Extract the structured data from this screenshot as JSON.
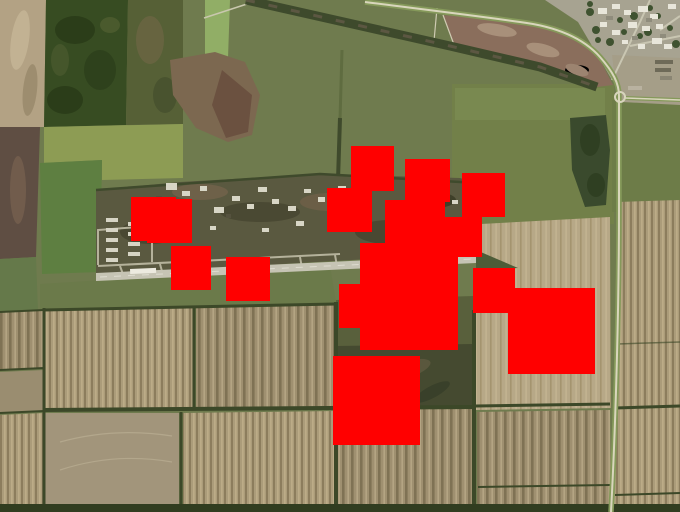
{
  "map": {
    "view": "satellite",
    "scene": {
      "description": "Aerial satellite view of a military airfield with runway, taxiways and aircraft stands, surrounded by plowed crop parcels, a forest block, tree-lined roads and a village in the upper right.",
      "features": [
        "airfield-base",
        "runway",
        "parking-apron",
        "forest",
        "farm-parcels",
        "village",
        "roads",
        "tree-lines"
      ]
    }
  },
  "overlays": {
    "color": "#ff0000",
    "shape": "square",
    "count": 15,
    "boxes": [
      {
        "x": 131,
        "y": 197,
        "w": 45,
        "h": 44
      },
      {
        "x": 147,
        "y": 199,
        "w": 45,
        "h": 44
      },
      {
        "x": 171,
        "y": 246,
        "w": 40,
        "h": 44
      },
      {
        "x": 226,
        "y": 257,
        "w": 44,
        "h": 44
      },
      {
        "x": 351,
        "y": 146,
        "w": 43,
        "h": 45
      },
      {
        "x": 405,
        "y": 159,
        "w": 45,
        "h": 43
      },
      {
        "x": 462,
        "y": 173,
        "w": 43,
        "h": 44
      },
      {
        "x": 327,
        "y": 188,
        "w": 45,
        "h": 44
      },
      {
        "x": 385,
        "y": 200,
        "w": 60,
        "h": 47
      },
      {
        "x": 441,
        "y": 217,
        "w": 41,
        "h": 40
      },
      {
        "x": 360,
        "y": 243,
        "w": 98,
        "h": 107
      },
      {
        "x": 339,
        "y": 284,
        "w": 46,
        "h": 44
      },
      {
        "x": 473,
        "y": 268,
        "w": 42,
        "h": 45
      },
      {
        "x": 508,
        "y": 288,
        "w": 87,
        "h": 86
      },
      {
        "x": 333,
        "y": 356,
        "w": 87,
        "h": 89
      }
    ]
  },
  "palette": {
    "olive_field": "#6f7b4e",
    "forest": "#374c22",
    "tan_field": "#b3a284",
    "striped_field": "#a39472",
    "airbase_ground": "#5a5940",
    "runway": "#c6c4b4",
    "village_ground": "#a7a391",
    "detection_red": "#ff0000"
  }
}
